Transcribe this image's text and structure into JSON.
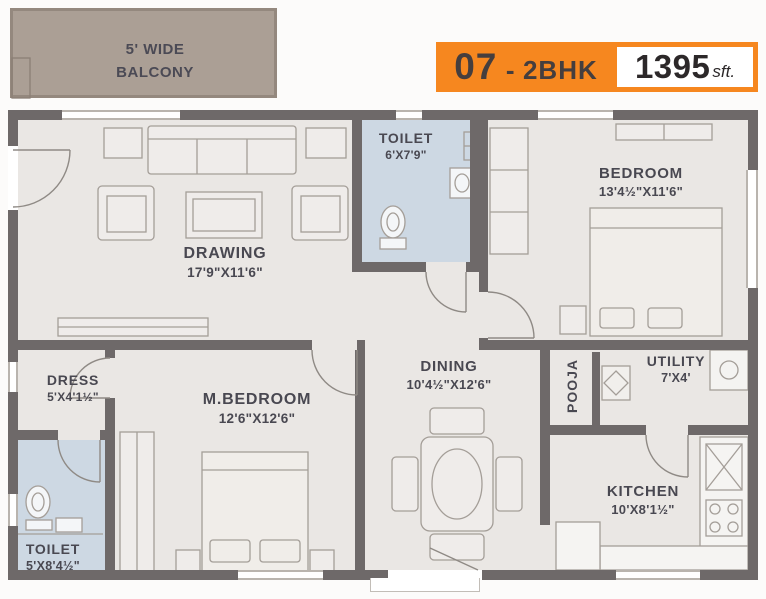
{
  "badge": {
    "unit": "07",
    "dash": "-",
    "type": "2BHK",
    "area": "1395",
    "area_unit": "sft."
  },
  "balcony": {
    "line1": "5' WIDE",
    "line2": "BALCONY"
  },
  "rooms": {
    "drawing": {
      "name": "DRAWING",
      "dims": "17'9\"X11'6\""
    },
    "toilet_top": {
      "name": "TOILET",
      "dims": "6'X7'9\""
    },
    "bedroom": {
      "name": "BEDROOM",
      "dims": "13'4½\"X11'6\""
    },
    "dress": {
      "name": "DRESS",
      "dims": "5'X4'1½\""
    },
    "master_bedroom": {
      "name": "M.BEDROOM",
      "dims": "12'6\"X12'6\""
    },
    "dining": {
      "name": "DINING",
      "dims": "10'4½\"X12'6\""
    },
    "pooja": {
      "name": "POOJA"
    },
    "utility": {
      "name": "UTILITY",
      "dims": "7'X4'"
    },
    "kitchen": {
      "name": "KITCHEN",
      "dims": "10'X8'1½\""
    },
    "toilet_bottom": {
      "name": "TOILET",
      "dims": "5'X8'4½\""
    }
  },
  "colors": {
    "badge_orange": "#f6871f",
    "wall": "#6e6969",
    "floor": "#eae7e4",
    "toilet_floor": "#cdd8e3",
    "balcony": "#ab9f95",
    "label_text": "#494851"
  }
}
